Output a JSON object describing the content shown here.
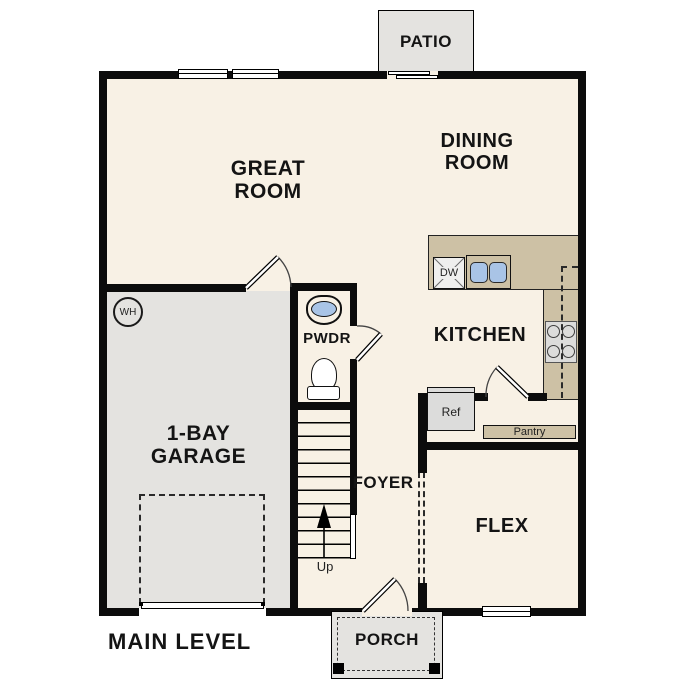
{
  "title": "MAIN LEVEL",
  "colors": {
    "floor": "#f8f1e5",
    "outdoor_concrete": "#e4e3e0",
    "counter_tan": "#cdc1a5",
    "sink_blue": "#a9c4e6",
    "wall_black": "#0c0c0c",
    "appliance_gray": "#dcdcdb"
  },
  "rooms": {
    "patio": {
      "label": "PATIO"
    },
    "great_room": {
      "line1": "GREAT",
      "line2": "ROOM"
    },
    "dining_room": {
      "line1": "DINING",
      "line2": "ROOM"
    },
    "kitchen": {
      "label": "KITCHEN"
    },
    "powder": {
      "label": "PWDR"
    },
    "garage": {
      "line1": "1-BAY",
      "line2": "GARAGE"
    },
    "foyer": {
      "label": "FOYER"
    },
    "flex": {
      "label": "FLEX"
    },
    "porch": {
      "label": "PORCH"
    }
  },
  "fixtures": {
    "water_heater": "WH",
    "dishwasher": "DW",
    "refrigerator": "Ref",
    "pantry": "Pantry",
    "stairs_direction": "Up"
  }
}
